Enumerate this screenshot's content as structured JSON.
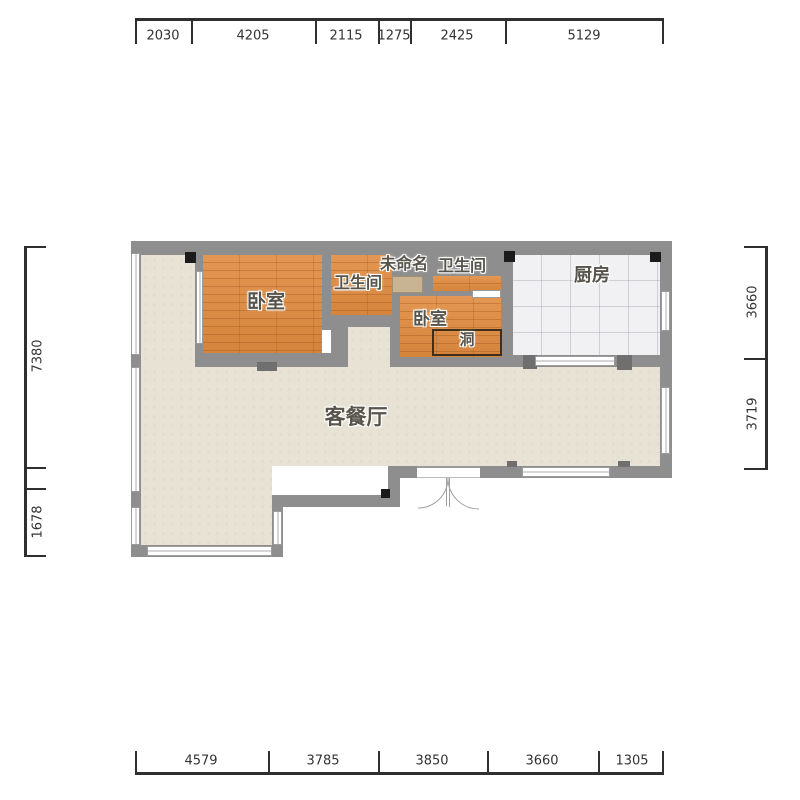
{
  "dims": {
    "top": {
      "values": [
        "2030",
        "4205",
        "2115",
        "1275",
        "2425",
        "5129"
      ]
    },
    "bottom": {
      "values": [
        "4579",
        "3785",
        "3850",
        "3660",
        "1305"
      ]
    },
    "left": {
      "values": [
        "7380",
        "1678"
      ]
    },
    "right": {
      "values": [
        "3660",
        "3719"
      ]
    }
  },
  "rooms": {
    "bedroom1": "卧室",
    "bath1": "卫生间",
    "unnamed": "未命名",
    "bath2": "卫生间",
    "kitchen": "厨房",
    "bedroom2": "卧室",
    "hole": "洞",
    "living": "客餐厅"
  },
  "colors": {
    "wall": "#8e8e8e",
    "wood_floor": "#e08b3f",
    "living_floor": "#e7e2d4",
    "kitchen_floor": "#f1f1f3",
    "unnamed_floor": "#c8b493",
    "dimension_text": "#333333",
    "label_text": "#57544b"
  }
}
